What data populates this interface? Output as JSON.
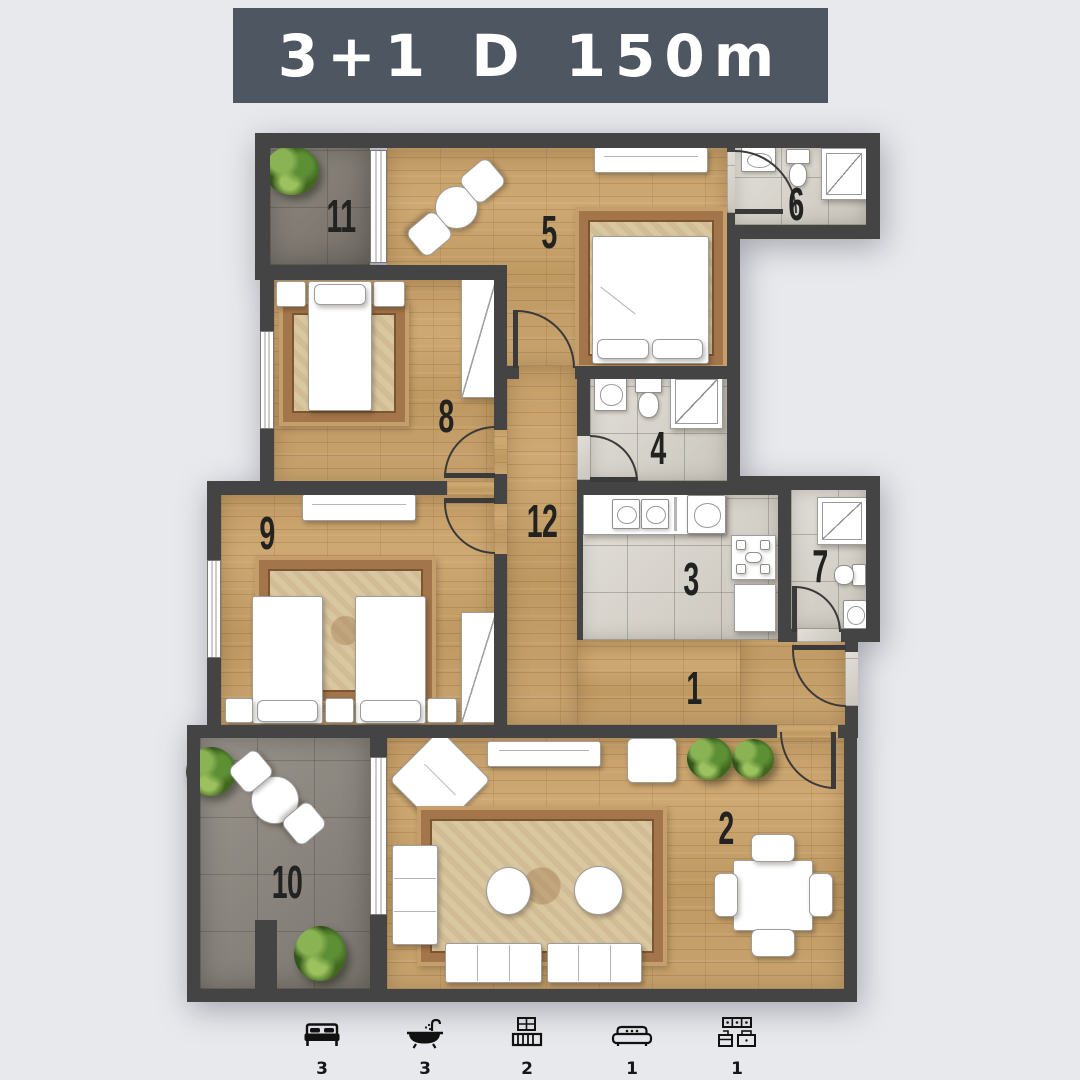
{
  "title": "3+1 D 150m",
  "plan_type": "apartment-floor-plan",
  "rooms": [
    {
      "number": "1",
      "type": "entrance-hall"
    },
    {
      "number": "2",
      "type": "living-dining-room"
    },
    {
      "number": "3",
      "type": "kitchen"
    },
    {
      "number": "4",
      "type": "bathroom"
    },
    {
      "number": "5",
      "type": "bedroom"
    },
    {
      "number": "6",
      "type": "bathroom"
    },
    {
      "number": "7",
      "type": "bathroom"
    },
    {
      "number": "8",
      "type": "bedroom"
    },
    {
      "number": "9",
      "type": "bedroom"
    },
    {
      "number": "10",
      "type": "terrace"
    },
    {
      "number": "11",
      "type": "balcony"
    },
    {
      "number": "12",
      "type": "hallway"
    }
  ],
  "legend": {
    "items": [
      {
        "icon": "bed-icon",
        "count": "3"
      },
      {
        "icon": "bath-icon",
        "count": "3"
      },
      {
        "icon": "balcony-icon",
        "count": "2"
      },
      {
        "icon": "sofa-icon",
        "count": "1"
      },
      {
        "icon": "kitchen-icon",
        "count": "1"
      }
    ]
  },
  "colors": {
    "background": "#e8e9ed",
    "banner": "#4e5661",
    "banner_text": "#ffffff",
    "wall": "#454444",
    "wood_floor": "#c7a26d",
    "tile_floor": "#d9d5cc",
    "terrace_floor": "#928c84",
    "plant": "#3f6b24",
    "label": "#222220"
  }
}
